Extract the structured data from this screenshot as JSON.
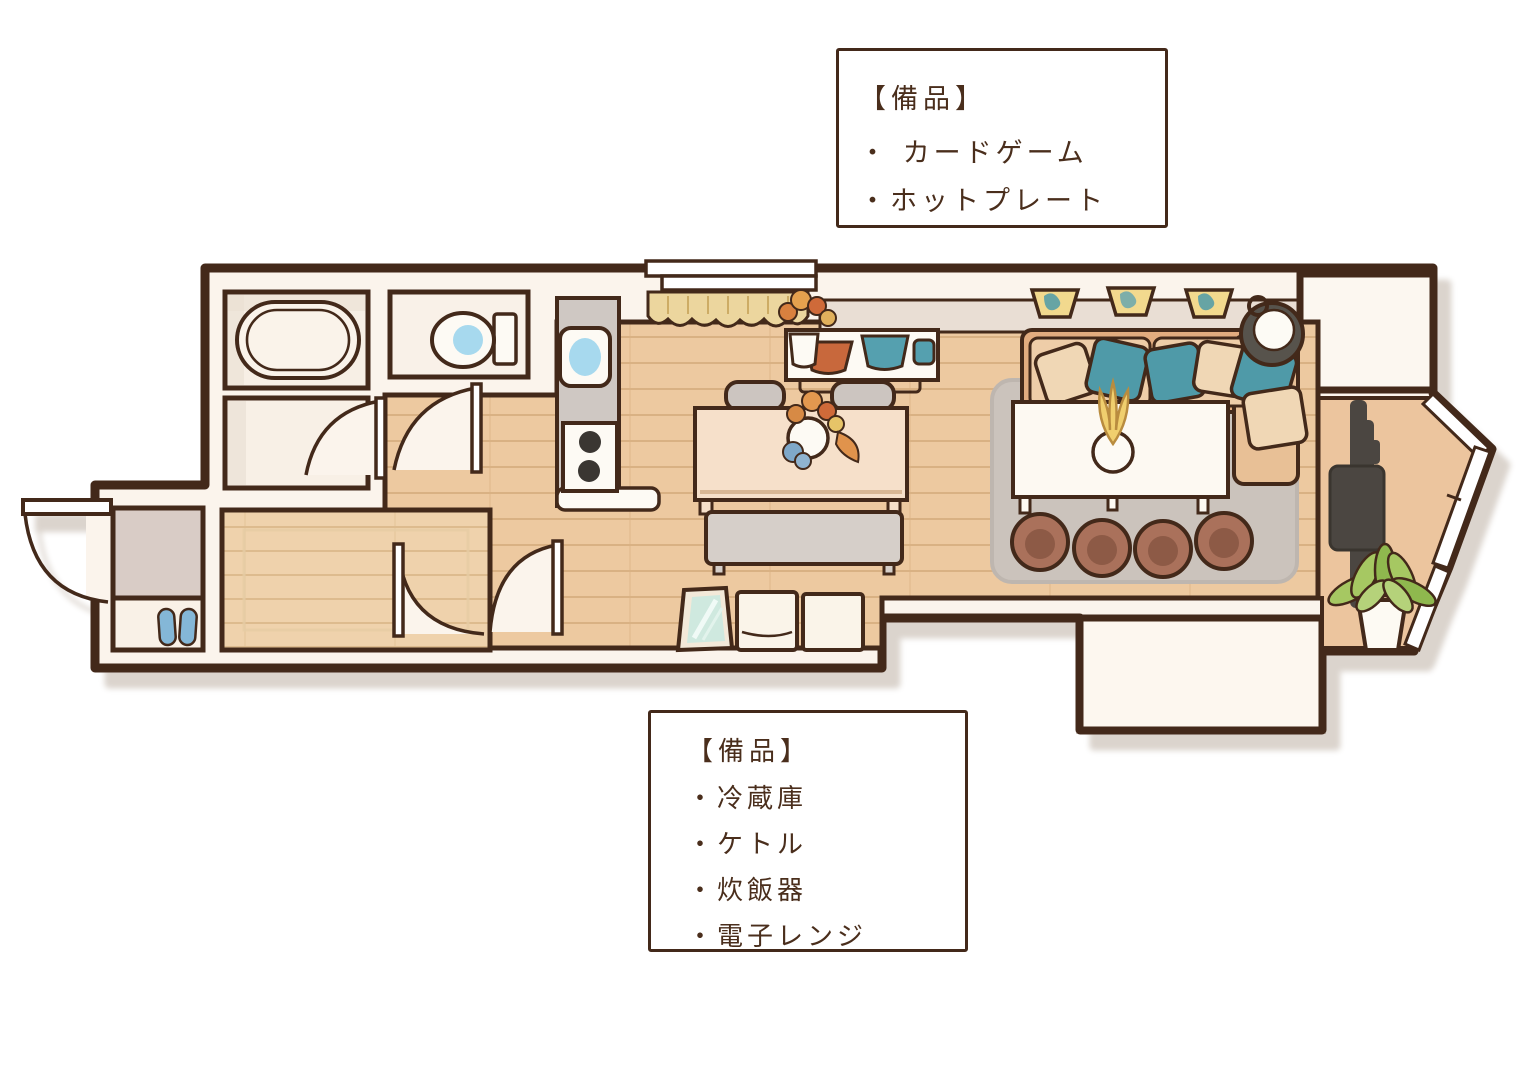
{
  "annotation_boxes": {
    "top": {
      "title": "【備品】",
      "items": [
        "・ カードゲーム",
        "・ホットプレート"
      ]
    },
    "bottom": {
      "title": "【備品】",
      "items": [
        "・冷蔵庫",
        "・ケトル",
        "・炊飯器",
        "・電子レンジ"
      ]
    }
  },
  "palette": {
    "wall_line": "#43291a",
    "wall_fill": "#fbf4ec",
    "wood_floor": "#edc9a0",
    "wood_plank_line": "#d9b183",
    "bedroom_wood": "#efd2ac",
    "balcony_floor": "#ecc59e",
    "entrance_tile": "#d9ccc6",
    "room_cream": "#f8f0e6",
    "counter_gray": "#cfc8c3",
    "ledge_gray": "#e9ded4",
    "rug_gray": "#cbc3bc",
    "accent_teal": "#4f9aa8",
    "water_blue": "#a7d9ee",
    "slipper_blue": "#84b7d7",
    "planter_yellow": "#f2d98e",
    "bowl_orange": "#c8683c",
    "cushion_brown": "#aa715b",
    "sofa_tan": "#e2ac7f",
    "cushion_cream": "#f0d7b5",
    "tv_dark": "#4b4641",
    "plant_green": "#a6c862",
    "text_brown": "#4a2e1c",
    "shadow": "#d9d1c9"
  },
  "floorplan": {
    "objects": [
      "bathtub",
      "toilet",
      "kitchen-sink",
      "gas-stove",
      "kitchen-counter",
      "kitchen-window",
      "curtain",
      "sideboard",
      "flower-bouquet",
      "dining-table",
      "dining-chair",
      "bench",
      "rug",
      "living-table",
      "table-plant",
      "sofa",
      "sofa-pillows",
      "floor-cushions",
      "planters",
      "basket",
      "tv",
      "potted-plant",
      "bay-windows",
      "mirror",
      "storage-boxes",
      "slippers",
      "entrance-door",
      "interior-door",
      "closet-nook",
      "bump-out"
    ]
  }
}
